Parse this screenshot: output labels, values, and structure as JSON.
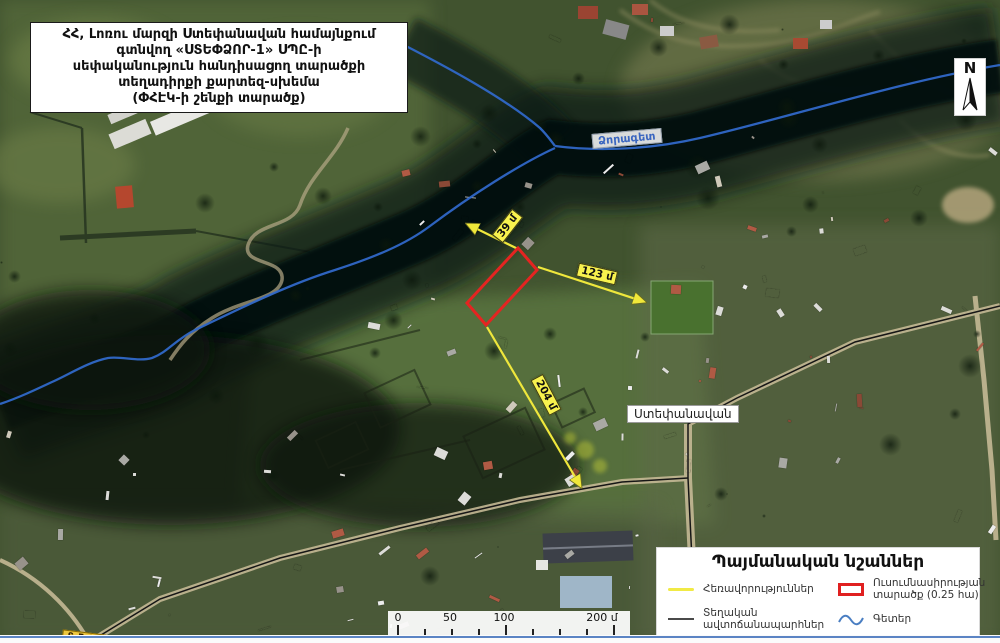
{
  "title": {
    "lines": [
      "ՀՀ, Լոռու մարզի Ստեփանավան համայնքում",
      "գտնվող «ՍՏԵՓՁՈՐ-1» ՍՊԸ-ի",
      "սեփականություն հանդիսացող տարածքի",
      "տեղադիրքի քարտեզ-սխեմա",
      "(ՓՀԷԿ-ի շենքի տարածք)"
    ]
  },
  "map_labels": {
    "river": "Ձորագետ",
    "city": "Ստեփանավան",
    "distance_to_river": "39 մ",
    "distance_to_building": "123 մ",
    "distance_to_road": "204 մ",
    "road_sign": "Տ-5-24"
  },
  "north_arrow": {
    "label": "N"
  },
  "legend": {
    "title": "Պայմանական նշաններ",
    "items": [
      {
        "id": "distances",
        "label": "Հեռավորություններ"
      },
      {
        "id": "local-roads",
        "label": "Տեղական ավտոճանապարհներ"
      },
      {
        "id": "study-area",
        "label": "Ուսումնասիրության տարածք (0.25 հա)"
      },
      {
        "id": "rivers",
        "label": "Գետեր"
      }
    ]
  },
  "scale_bar": {
    "labels": [
      "0",
      "50",
      "100",
      "200 մ"
    ]
  },
  "colors": {
    "study_area": "#e02020",
    "distance_line": "#efe73c",
    "river_line": "#3068c8",
    "road_line": "#161616",
    "label_bg": "#f8f24e"
  }
}
